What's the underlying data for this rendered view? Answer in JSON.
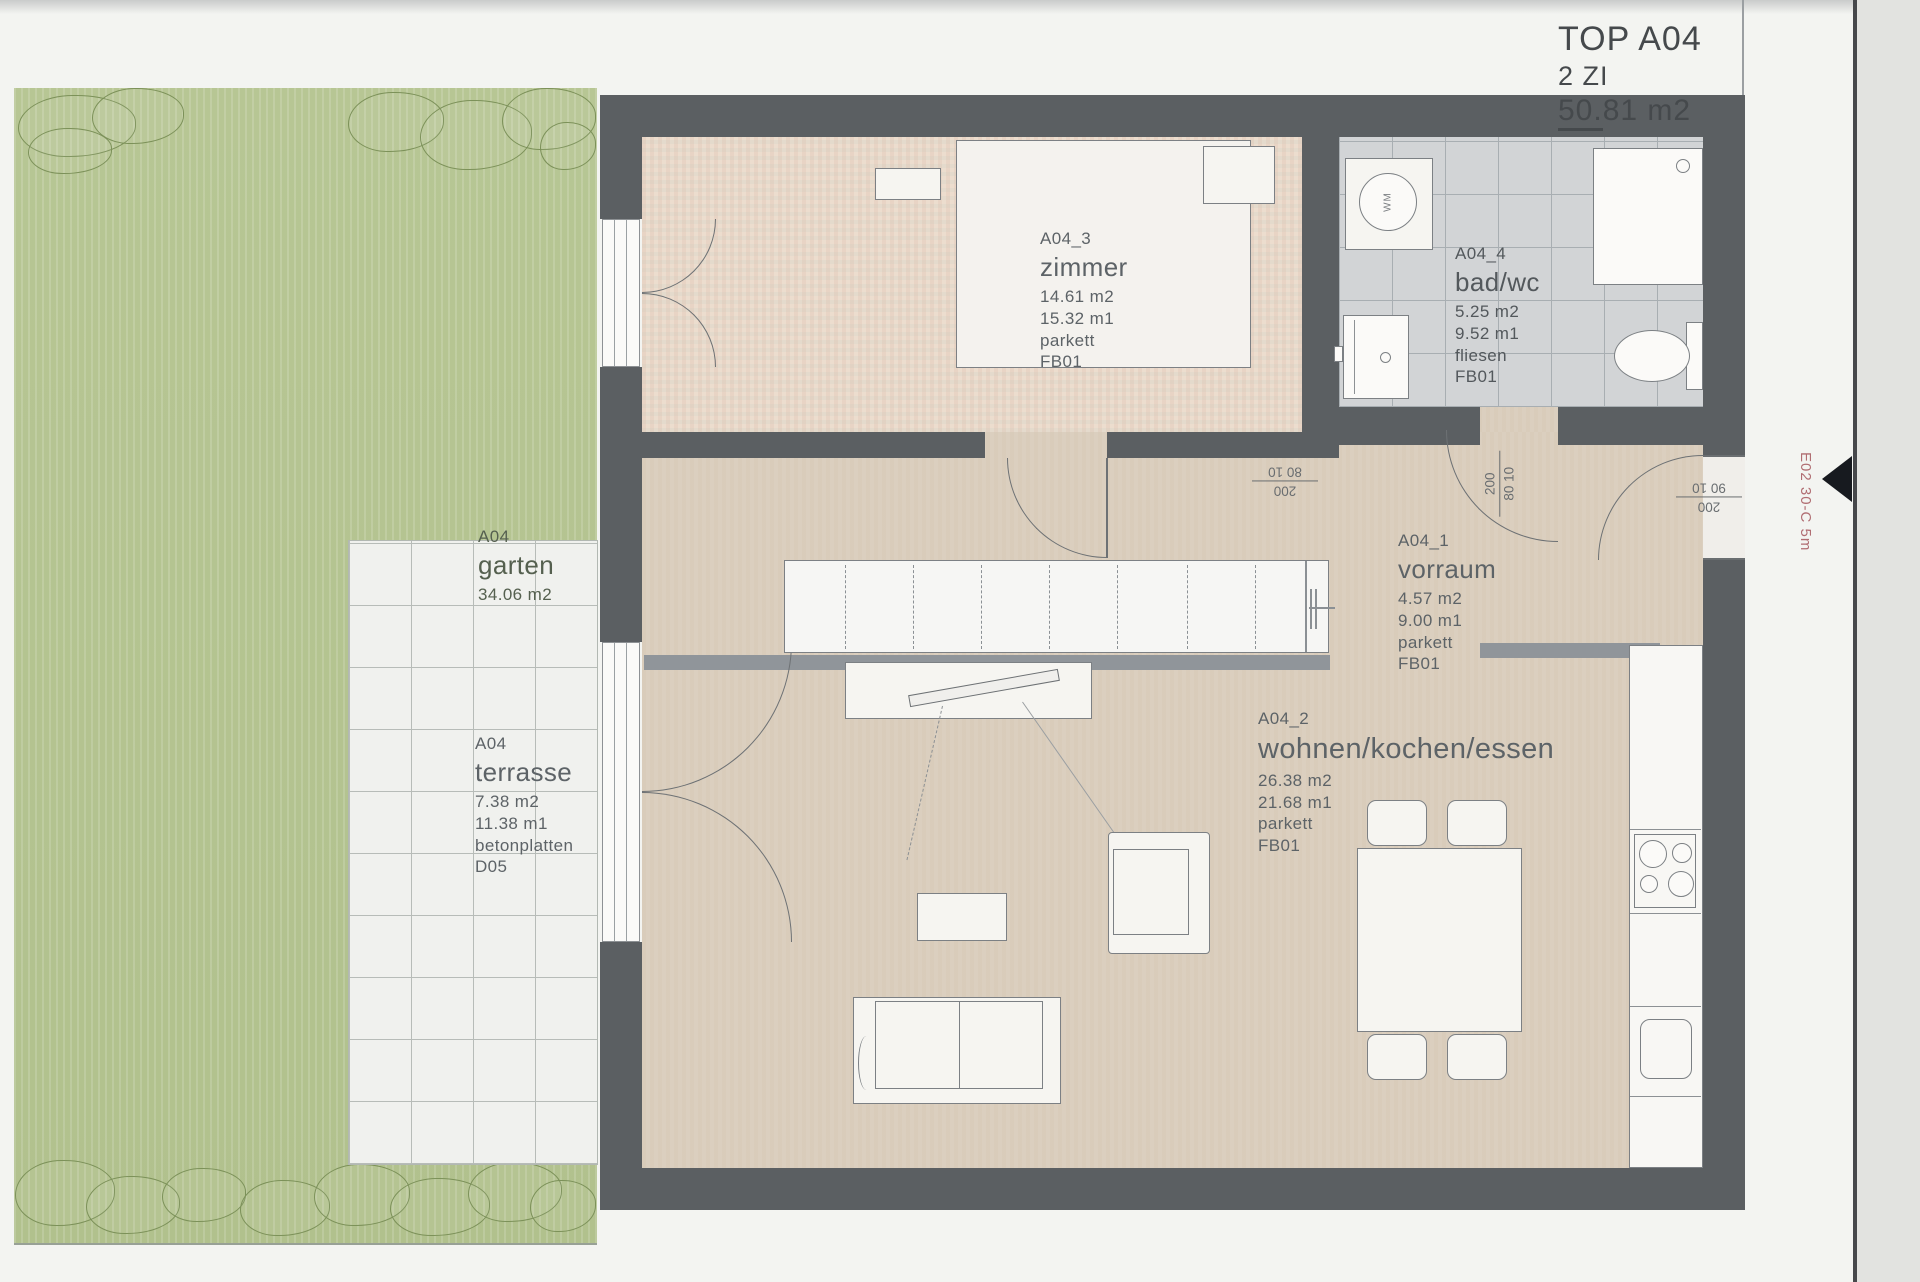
{
  "title": {
    "project": "TOP A04",
    "rooms_line": "2 ZI",
    "area_underline": "50.",
    "area_rest": "81 m2"
  },
  "side_note": {
    "text": "E02 30-C 5m"
  },
  "rooms": {
    "zimmer": {
      "id": "A04_3",
      "name": "zimmer",
      "area": "14.61 m2",
      "perimeter": "15.32 m1",
      "floor": "parkett",
      "code": "FB01"
    },
    "bad": {
      "id": "A04_4",
      "name": "bad/wc",
      "area": "5.25 m2",
      "perimeter": "9.52 m1",
      "floor": "fliesen",
      "code": "FB01"
    },
    "vorraum": {
      "id": "A04_1",
      "name": "vorraum",
      "area": "4.57 m2",
      "perimeter": "9.00 m1",
      "floor": "parkett",
      "code": "FB01"
    },
    "wohnen": {
      "id": "A04_2",
      "name": "wohnen/kochen/essen",
      "area": "26.38 m2",
      "perimeter": "21.68 m1",
      "floor": "parkett",
      "code": "FB01"
    }
  },
  "outdoor": {
    "garten": {
      "id": "A04",
      "name": "garten",
      "area": "34.06 m2"
    },
    "terrasse": {
      "id": "A04",
      "name": "terrasse",
      "area": "7.38 m2",
      "perimeter": "11.38 m1",
      "floor": "betonplatten",
      "code": "D05"
    }
  },
  "doors": {
    "zimmer_door": {
      "num": "200",
      "den": "80 10"
    },
    "bad_door": {
      "num": "200",
      "den": "80 10"
    },
    "entrance_door": {
      "num": "200",
      "den": "90 10"
    }
  },
  "fixtures": {
    "washer": "WM"
  },
  "colors": {
    "wall": "#5b5f62",
    "garden_green": "#b4c391",
    "floor_beige": "#dbcfbf",
    "floor_rose": "#ecddce",
    "tile_gray": "#d2d4d6",
    "annotation_red": "#b06d72"
  }
}
